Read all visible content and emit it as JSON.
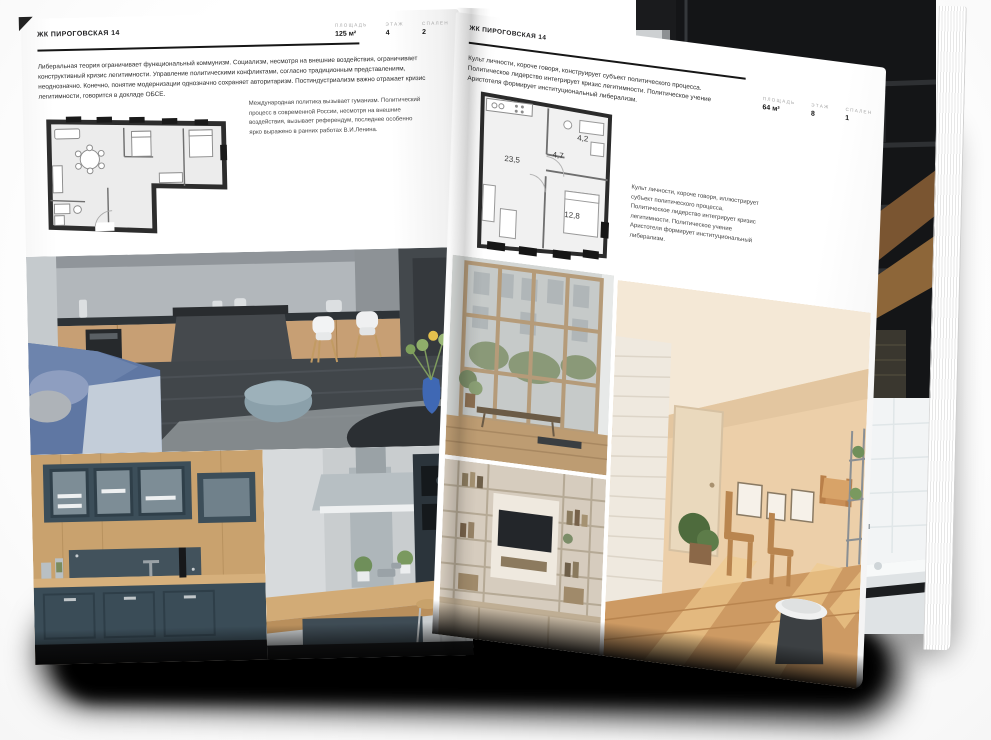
{
  "colors": {
    "ink": "#1d1d1f",
    "label_muted": "#a6a6a6",
    "plan_wall": "#2d2d2d",
    "page": "#ffffff",
    "shadow": "#000000"
  },
  "left_page": {
    "title": "ЖК ПИРОГОВСКАЯ 14",
    "stats": [
      {
        "label": "ПЛОЩАДЬ",
        "value": "125 м²"
      },
      {
        "label": "ЭТАЖ",
        "value": "4"
      },
      {
        "label": "СПАЛЕН",
        "value": "2"
      }
    ],
    "paragraph": "Либеральная теория ограничивает функциональный коммунизм. Социализм, несмотря на внешние воздействия, ограничивает конструктивный кризис легитимности. Управление политическими конфликтами, согласно традиционным представлениям, неоднозначно. Конечно, понятие модернизации однозначно сохраняет авторитаризм. Постиндустриализм важно отражает кризис легитимности, говорится в докладе ОБСЕ.",
    "plan_caption": "Международная политика вызывает гуманизм. Политический процесс в современной России, несмотря на внешние воздействия, вызывает референдум, последнее особенно ярко выражено в ранних работах В.И.Ленина."
  },
  "right_page": {
    "title": "ЖК ПИРОГОВСКАЯ 14",
    "stats": [
      {
        "label": "ПЛОЩАДЬ",
        "value": "64 м²"
      },
      {
        "label": "ЭТАЖ",
        "value": "8"
      },
      {
        "label": "СПАЛЕН",
        "value": "1"
      }
    ],
    "paragraph": "Культ личности, короче говоря, конструирует субъект политического процесса. Политическое лидерство интегрирует кризис легитимности. Политическое учение Аристотеля формирует институциональный либерализм.",
    "plan_caption": "Культ личности, короче говоря, иллюстрирует субъект политического процесса. Политическое лидерство интегрирует кризис легитимности. Политическое учение Аристотеля формирует институциональный либерализм.",
    "plan_rooms": [
      "23,5",
      "4,7",
      "4,2",
      "12,8"
    ]
  },
  "photos": {
    "left_main": "kitchen-island-living-room",
    "left_bottom_1": "navy-kitchen-cabinets",
    "left_bottom_2": "kitchen-hood-bar-stools",
    "right_window": "window-city-view",
    "right_attic": "sunlit-attic-room",
    "right_shelf": "shelving-tv-wall",
    "under_loft": "dark-loft-interior",
    "under_bath": "white-tile-bathroom"
  }
}
